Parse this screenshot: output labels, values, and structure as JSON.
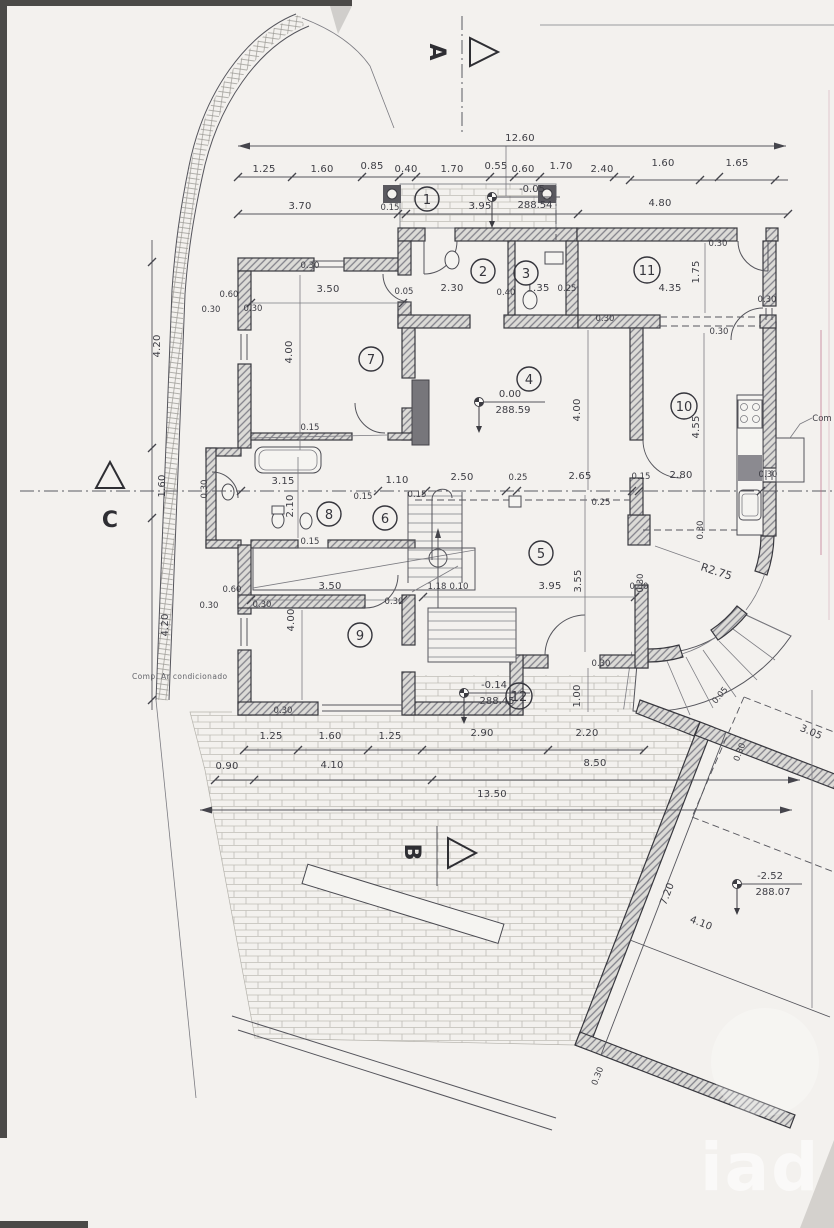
{
  "sections": {
    "a": "A",
    "b": "B",
    "c": "C"
  },
  "rooms": {
    "r1": "1",
    "r2": "2",
    "r3": "3",
    "r4": "4",
    "r5": "5",
    "r6": "6",
    "r7": "7",
    "r8": "8",
    "r9": "9",
    "r10": "10",
    "r11": "11",
    "r12": "12"
  },
  "levels": {
    "porch": {
      "rel": "-0.05",
      "abs": "288.54"
    },
    "ground": {
      "rel": "0.00",
      "abs": "288.59"
    },
    "terrace": {
      "rel": "-0.14",
      "abs": "288.45"
    },
    "pool": {
      "rel": "-2.52",
      "abs": "288.07"
    }
  },
  "notes": {
    "ac": "Comp. Ar condicionado",
    "radius": "R2.75",
    "edge": "Com"
  },
  "watermark": "iad",
  "dims": {
    "top_total": "12.60",
    "top_chain": [
      "1.25",
      "1.60",
      "0.85",
      "0.40",
      "1.70",
      "0.55",
      "0.60",
      "1.70",
      "2.40"
    ],
    "top_right": [
      "1.60",
      "1.65"
    ],
    "porch_row": [
      "3.70",
      "0.15",
      "3.95",
      "4.80"
    ],
    "upper": [
      "0.30",
      "3.50",
      "0.05",
      "2.30",
      "0.40",
      "1.35",
      "0.25",
      "0.30",
      "4.35",
      "1.75",
      "0.30",
      "0.30"
    ],
    "left_chain": [
      "4.20",
      "1.60",
      "4.20"
    ],
    "left_off": [
      "0.60",
      "0.30",
      "0.30",
      "0.60",
      "0.30",
      "0.30"
    ],
    "room7": [
      "4.00",
      "0.15"
    ],
    "room4": [
      "4.00"
    ],
    "kitchen": [
      "0.30",
      "4.55",
      "2.80",
      "0.30"
    ],
    "bath": [
      "3.15",
      "2.10",
      "1.10",
      "0.15",
      "0.15",
      "0.15",
      "0.30"
    ],
    "hall": [
      "2.50",
      "0.25",
      "2.65",
      "0.15",
      "0.25"
    ],
    "room5": [
      "3.95",
      "3.55",
      "0.30",
      "1.18",
      "0.10",
      "0.30",
      "0.30"
    ],
    "room9": [
      "3.50",
      "0.30",
      "4.00",
      "0.30"
    ],
    "terrace12": [
      "0.30",
      "1.00",
      "2.90",
      "2.20"
    ],
    "lower_chain": [
      "1.25",
      "1.60",
      "1.25"
    ],
    "site_chain": [
      "0.90",
      "4.10",
      "8.50"
    ],
    "site_total": "13.50",
    "pool": [
      "7.20",
      "4.10",
      "0.30",
      "3.05",
      "0.30",
      "0.05"
    ]
  }
}
